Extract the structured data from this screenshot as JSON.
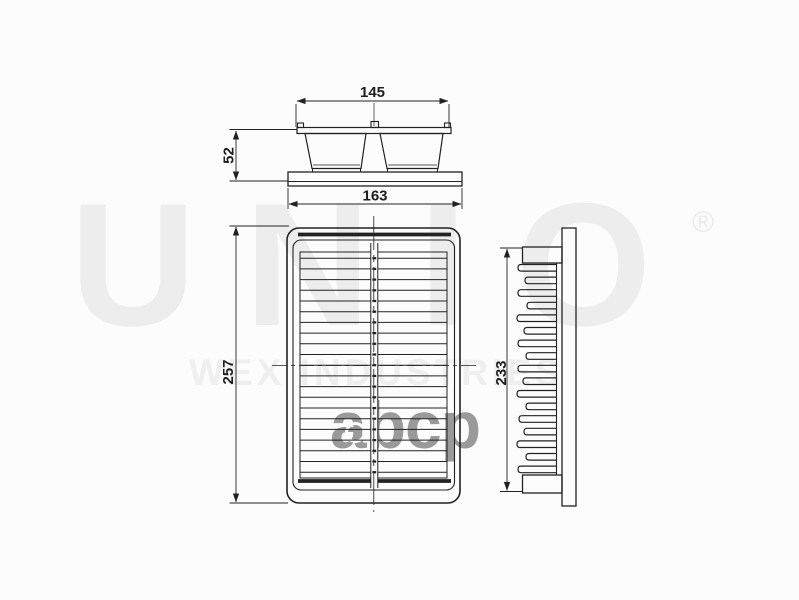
{
  "watermark": {
    "brand": "UNIO",
    "registered_mark": "®",
    "company": "WEX INDUSTRIES",
    "marketplace_logo": "abcp"
  },
  "drawing": {
    "front_view": {
      "width_top": "145",
      "height": "52",
      "width_base": "163"
    },
    "top_view": {
      "length": "257"
    },
    "side_view": {
      "length": "233"
    }
  },
  "colors": {
    "line": "#222222",
    "watermark_light": "#ededed",
    "watermark_gray": "#9a9a9a",
    "background": "#fcfcfc"
  }
}
